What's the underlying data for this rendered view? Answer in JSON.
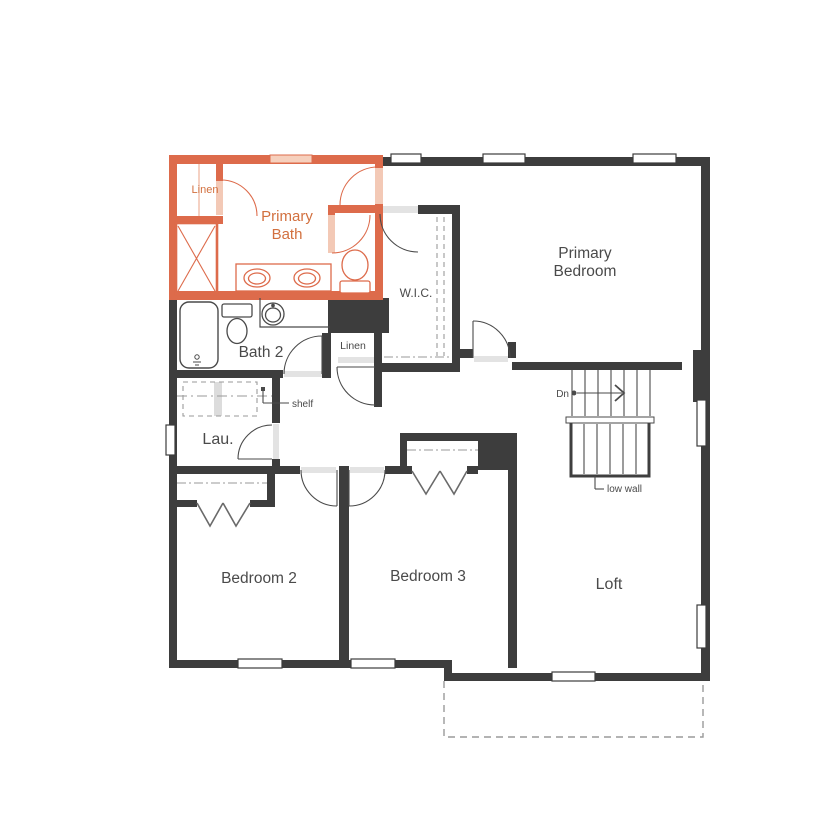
{
  "plan": {
    "type": "floor-plan",
    "floor": "upper",
    "colors": {
      "accent_wall": "#DD6B4B",
      "accent_text": "#D2703F",
      "wall": "#3D3D3D",
      "line": "#4A4A4A",
      "dashed": "#9A9A9A",
      "background": "#FFFFFF"
    },
    "rooms": {
      "primary_bath": {
        "line1": "Primary",
        "line2": "Bath",
        "highlighted": true
      },
      "linen_bath": {
        "label": "Linen"
      },
      "primary_bedroom": {
        "line1": "Primary",
        "line2": "Bedroom"
      },
      "wic": {
        "label": "W.I.C."
      },
      "bath2": {
        "label": "Bath 2"
      },
      "linen_hall": {
        "label": "Linen"
      },
      "laundry": {
        "label": "Lau."
      },
      "bedroom2": {
        "label": "Bedroom 2"
      },
      "bedroom3": {
        "label": "Bedroom 3"
      },
      "loft": {
        "label": "Loft"
      }
    },
    "annotations": {
      "shelf": "shelf",
      "down": "Dn",
      "low_wall": "low wall"
    }
  }
}
